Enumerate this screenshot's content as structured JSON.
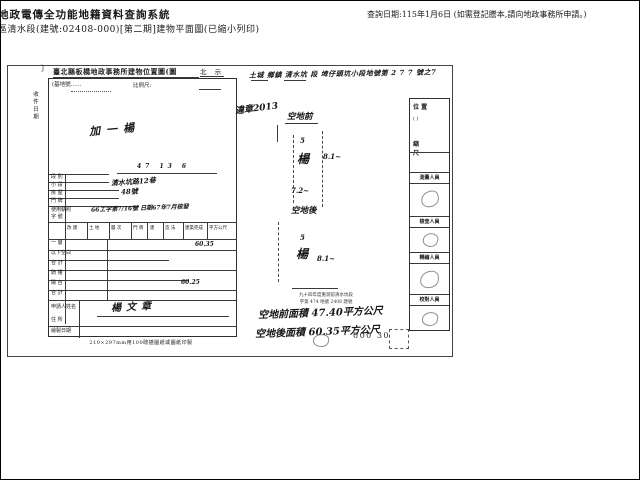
{
  "header": {
    "system_title": "地政電傳全功能地籍資料查詢系統",
    "doc_line": "區清水段(建號:02408-000)[第二期]建物平面圖(已縮小列印)",
    "query_date": "查詢日期:115年1月6日 (如需登記謄本,請向地政事務所申請。)"
  },
  "scan": {
    "left_margin_mark": "〕",
    "left_margin_vertical": "收件日期",
    "form": {
      "title": "臺北縣板橋地政事務所建物位置圖(圖",
      "north_label": "北 示",
      "base_no_label": "(基地號……",
      "scale_label": "比例尺:",
      "sketch_note": "加一楊",
      "sketch_dim": "47 13 6",
      "row_labels": [
        "段 別",
        "小 段",
        "房 屋",
        "門 牌",
        "使用執照",
        "字 號"
      ],
      "hw_address1": "清水坑路12巷",
      "hw_address2": "48號",
      "hw_permit": "66工字第7/16號 日期67年7月核發",
      "table_columns": [
        "改 建",
        "土 地",
        "層 次",
        "門 牌",
        "建",
        "造 法",
        "建築完成",
        "平方公尺"
      ],
      "area_row_labels": [
        "一 層",
        "以下空白",
        "合 計",
        "騎 樓",
        "陽 台",
        "合 計"
      ],
      "hw_num1": "60.35",
      "hw_num2": "60.25",
      "applicant_label": "申請人姓名",
      "hw_signature": "楊文章",
      "address_label": "住 所",
      "date_label": "繪製日期",
      "caption": "210×297mm用100磅描圖紙或圖紙印製"
    },
    "plan": {
      "land_line": "土城 鄉鎮 清水坑 段 埤仔頭坑小段地號第 2 7 7 號之7",
      "note": "違章2013",
      "front_label": "空地前",
      "back_label": "空地後",
      "bldg1": "楊",
      "bldg2": "楊",
      "dim_left1": "5",
      "dim_right1": "8.1~",
      "dim_bottom1": "7.2~",
      "dim_left2": "5",
      "dim_right2": "8.1~",
      "stamp_line1": "九十四年度重測前清水坑段",
      "stamp_line2": "字第 474 地號 2408 建號",
      "hw_area_front": "空地前面積 47.40平方公尺",
      "hw_area_back": "空地後面積 60.35平方公尺",
      "page_stamp": "000 30"
    },
    "strip": {
      "pos_title": "位 置",
      "pos_paren": "(    )",
      "scale_title": "縮 尺",
      "staff": [
        {
          "label": "測量人員"
        },
        {
          "label": "檢查人員"
        },
        {
          "label": "轉繪人員"
        },
        {
          "label": "校對人員"
        }
      ]
    }
  }
}
